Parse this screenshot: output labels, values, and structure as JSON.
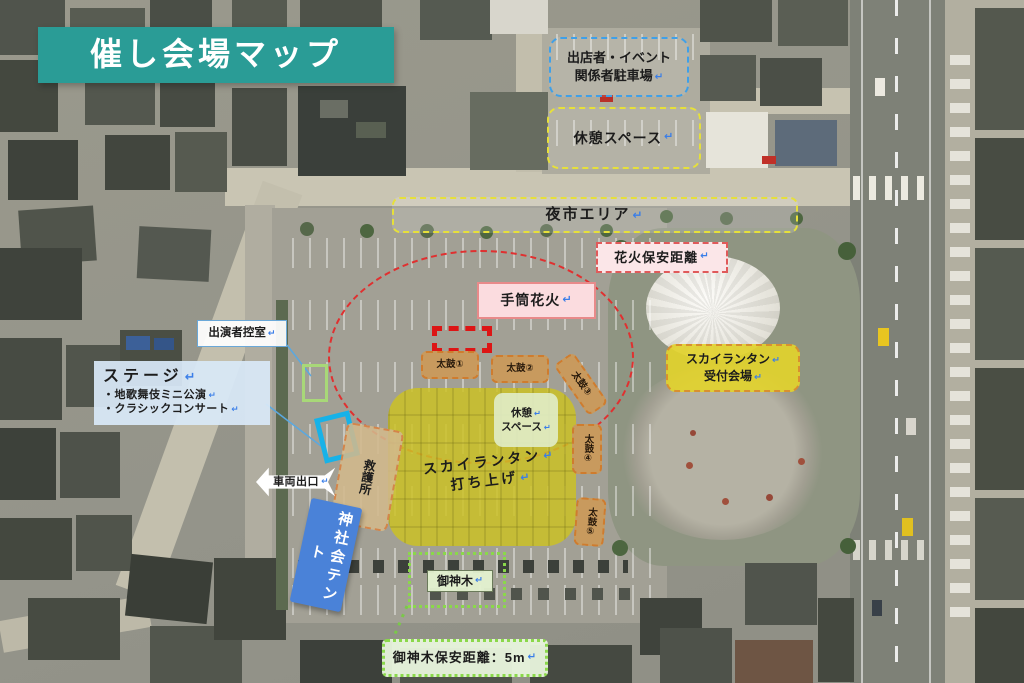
{
  "title": "催し会場マップ",
  "glyphs": {
    "return_arrow": "↵"
  },
  "colors": {
    "banner_teal": "#2a9c96",
    "launch_zone_yellow": "#cbc126",
    "safety_circle_red": "#e03030",
    "tent_blue": "#4a82d8",
    "taiko_tan": "#c89a5e",
    "stage_cyan": "#17b2e8"
  },
  "areas": {
    "vendor_parking_line1": "出店者・イベント",
    "vendor_parking_line2": "関係者駐車場",
    "rest_space_top": "休憩スペース",
    "night_market": "夜市エリア",
    "fireworks_safety": "花火保安距離",
    "tezutsu_fireworks": "手筒花火",
    "taiko": [
      "太鼓①",
      "太鼓②",
      "太鼓③",
      "太鼓④",
      "太鼓⑤"
    ],
    "first_aid": "救護所",
    "rest_space_center_line1": "休憩",
    "rest_space_center_line2": "スペース",
    "lantern_launch_line1": "スカイランタン",
    "lantern_launch_line2": "打ち上げ",
    "lantern_reception_line1": "スカイランタン",
    "lantern_reception_line2": "受付会場",
    "performer_room": "出演者控室",
    "stage_title": "ステージ",
    "stage_items": [
      "・地歌舞伎ミニ公演",
      "・クラシックコンサート"
    ],
    "vehicle_exit": "車両出口",
    "shrine_tent": "神社会テント",
    "sacred_tree": "御神木",
    "sacred_tree_safety": "御神木保安距離：5m"
  }
}
